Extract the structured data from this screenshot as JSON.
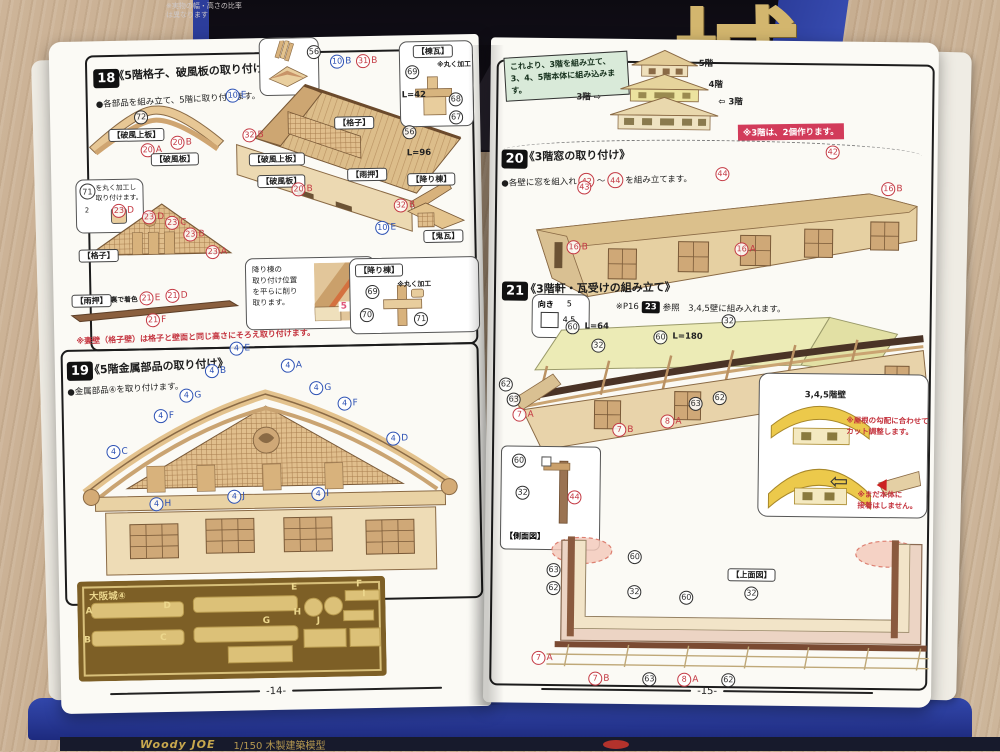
{
  "box": {
    "note": "※実物の幅・高さの比率\nは異なります",
    "kanji": "城",
    "brand": "Woody JOE",
    "brand_sub": "1/150 木製建築模型"
  },
  "left_page": {
    "footer": "-14-",
    "red_note": "※妻壁（格子壁）は格子と壁面と同じ高さにそろえ取り付けます。",
    "step18": {
      "num": "18",
      "title": "《5階格子、破風板の取り付け》",
      "bullet": "●各部品を組み立て、5階に取り付けます。",
      "note71": {
        "circ": "71",
        "text": "を丸く加工し\n取り付けます。",
        "sub": "2"
      },
      "oroshi_note": {
        "text": "降り棟の\n取り付け位置\nを平らに削り\n取ります。",
        "measure": "5 mm"
      },
      "labels": [
        {
          "k": "c",
          "n": "56",
          "x": 258,
          "y": 8
        },
        {
          "k": "c",
          "c": "c-blue",
          "n": "10",
          "s": "B",
          "x": 281,
          "y": 18
        },
        {
          "k": "c",
          "c": "c-red",
          "n": "31",
          "s": "B",
          "x": 307,
          "y": 18
        },
        {
          "k": "tag",
          "t": "【棟瓦】",
          "x": 364,
          "y": 10
        },
        {
          "k": "c",
          "n": "69",
          "x": 356,
          "y": 30
        },
        {
          "k": "txt",
          "t": "※丸く加工",
          "x": 388,
          "y": 27,
          "cls": "small"
        },
        {
          "k": "txt",
          "t": "L=42",
          "x": 352,
          "y": 56
        },
        {
          "k": "c",
          "n": "68",
          "x": 399,
          "y": 58
        },
        {
          "k": "c",
          "n": "67",
          "x": 399,
          "y": 76
        },
        {
          "k": "c",
          "c": "c-blue",
          "n": "10",
          "s": "E",
          "x": 176,
          "y": 50
        },
        {
          "k": "c",
          "n": "72",
          "x": 84,
          "y": 70
        },
        {
          "k": "tag",
          "t": "【破風上板】",
          "x": 58,
          "y": 88
        },
        {
          "k": "c",
          "c": "c-red",
          "n": "20",
          "s": "A",
          "x": 90,
          "y": 103
        },
        {
          "k": "c",
          "c": "c-red",
          "n": "20",
          "s": "B",
          "x": 120,
          "y": 96
        },
        {
          "k": "tag",
          "t": "【破風板】",
          "x": 100,
          "y": 113
        },
        {
          "k": "c",
          "c": "c-red",
          "n": "32",
          "s": "B",
          "x": 192,
          "y": 90
        },
        {
          "k": "tag",
          "t": "【破風上板】",
          "x": 198,
          "y": 115
        },
        {
          "k": "tag",
          "t": "【格子】",
          "x": 284,
          "y": 80
        },
        {
          "k": "c",
          "n": "56",
          "x": 352,
          "y": 90
        },
        {
          "k": "txt",
          "t": "L=96",
          "x": 356,
          "y": 114
        },
        {
          "k": "tag",
          "t": "【破風板】",
          "x": 206,
          "y": 137
        },
        {
          "k": "c",
          "c": "c-red",
          "n": "20",
          "s": "B",
          "x": 240,
          "y": 145
        },
        {
          "k": "tag",
          "t": "【雨押】",
          "x": 296,
          "y": 132
        },
        {
          "k": "tag",
          "t": "【降り棟】",
          "x": 356,
          "y": 138
        },
        {
          "k": "c",
          "c": "c-red",
          "n": "32",
          "s": "B",
          "x": 342,
          "y": 163
        },
        {
          "k": "c",
          "c": "c-blue",
          "n": "10",
          "s": "E",
          "x": 323,
          "y": 185
        },
        {
          "k": "tag",
          "t": "【鬼瓦】",
          "x": 371,
          "y": 195
        },
        {
          "k": "c",
          "c": "c-red",
          "n": "23",
          "s": "D",
          "x": 60,
          "y": 163
        },
        {
          "k": "c",
          "c": "c-red",
          "n": "23",
          "s": "D",
          "x": 90,
          "y": 170
        },
        {
          "k": "c",
          "c": "c-red",
          "n": "23",
          "s": "C",
          "x": 113,
          "y": 176
        },
        {
          "k": "c",
          "c": "c-red",
          "n": "23",
          "s": "B",
          "x": 131,
          "y": 188
        },
        {
          "k": "c",
          "c": "c-red",
          "n": "23",
          "s": "A",
          "x": 153,
          "y": 206
        },
        {
          "k": "tag",
          "t": "【格子】",
          "x": 26,
          "y": 208
        },
        {
          "k": "tag",
          "t": "【雨押】",
          "x": 18,
          "y": 253
        },
        {
          "k": "txt",
          "t": "裏で着色",
          "x": 57,
          "y": 256,
          "cls": "small"
        },
        {
          "k": "c",
          "c": "c-red",
          "n": "21",
          "s": "E",
          "x": 86,
          "y": 251
        },
        {
          "k": "c",
          "c": "c-red",
          "n": "21",
          "s": "D",
          "x": 112,
          "y": 249
        },
        {
          "k": "c",
          "c": "c-red",
          "n": "21",
          "s": "F",
          "x": 92,
          "y": 273
        },
        {
          "k": "tag",
          "t": "【降り棟】",
          "x": 302,
          "y": 228
        },
        {
          "k": "c",
          "n": "69",
          "x": 312,
          "y": 249
        },
        {
          "k": "txt",
          "t": "※丸く加工",
          "x": 344,
          "y": 246,
          "cls": "small"
        },
        {
          "k": "c",
          "n": "70",
          "x": 306,
          "y": 272
        },
        {
          "k": "c",
          "n": "71",
          "x": 360,
          "y": 277
        }
      ]
    },
    "step19": {
      "num": "19",
      "title": "《5階金属部品の取り付け》",
      "bullet": "●金属部品④を取り付けます。",
      "labels": [
        {
          "k": "c",
          "c": "c-blue",
          "n": "4",
          "s": "E",
          "x": 175,
          "y": 303
        },
        {
          "k": "c",
          "c": "c-blue",
          "n": "4",
          "s": "B",
          "x": 150,
          "y": 325
        },
        {
          "k": "c",
          "c": "c-blue",
          "n": "4",
          "s": "A",
          "x": 226,
          "y": 321
        },
        {
          "k": "c",
          "c": "c-blue",
          "n": "4",
          "s": "G",
          "x": 124,
          "y": 349
        },
        {
          "k": "c",
          "c": "c-blue",
          "n": "4",
          "s": "G",
          "x": 254,
          "y": 344
        },
        {
          "k": "c",
          "c": "c-blue",
          "n": "4",
          "s": "F",
          "x": 98,
          "y": 369
        },
        {
          "k": "c",
          "c": "c-blue",
          "n": "4",
          "s": "F",
          "x": 282,
          "y": 360
        },
        {
          "k": "c",
          "c": "c-blue",
          "n": "4",
          "s": "C",
          "x": 50,
          "y": 404
        },
        {
          "k": "c",
          "c": "c-blue",
          "n": "4",
          "s": "D",
          "x": 330,
          "y": 396
        },
        {
          "k": "c",
          "c": "c-blue",
          "n": "4",
          "s": "H",
          "x": 92,
          "y": 457
        },
        {
          "k": "c",
          "c": "c-blue",
          "n": "4",
          "s": "J",
          "x": 170,
          "y": 451
        },
        {
          "k": "c",
          "c": "c-blue",
          "n": "4",
          "s": "I",
          "x": 254,
          "y": 450
        }
      ]
    },
    "parts_sheet": {
      "title": "大阪城④",
      "labels": [
        {
          "k": "txt",
          "t": "A",
          "x": 26,
          "y": 566,
          "cls": "gold"
        },
        {
          "k": "txt",
          "t": "D",
          "x": 104,
          "y": 562,
          "cls": "gold"
        },
        {
          "k": "txt",
          "t": "E",
          "x": 232,
          "y": 546,
          "cls": "gold"
        },
        {
          "k": "txt",
          "t": "F",
          "x": 297,
          "y": 544,
          "cls": "gold"
        },
        {
          "k": "txt",
          "t": "H",
          "x": 234,
          "y": 571,
          "cls": "gold"
        },
        {
          "k": "txt",
          "t": "I",
          "x": 303,
          "y": 554,
          "cls": "gold"
        },
        {
          "k": "txt",
          "t": "B",
          "x": 24,
          "y": 595,
          "cls": "gold"
        },
        {
          "k": "txt",
          "t": "C",
          "x": 100,
          "y": 594,
          "cls": "gold"
        },
        {
          "k": "txt",
          "t": "G",
          "x": 203,
          "y": 579,
          "cls": "gold"
        },
        {
          "k": "txt",
          "t": "J",
          "x": 257,
          "y": 580,
          "cls": "gold"
        }
      ]
    }
  },
  "right_page": {
    "footer": "-15-",
    "intro": {
      "box": "これより、3階を組み立て、3、4、5階本体に組み込みます。",
      "badge": "※3階は、2個作ります。",
      "labels": [
        {
          "k": "txt",
          "t": "5階",
          "x": 208,
          "y": 20
        },
        {
          "k": "txt",
          "t": "4階",
          "x": 218,
          "y": 41
        },
        {
          "k": "txt",
          "t": "3階 ⇨",
          "x": 86,
          "y": 55
        },
        {
          "k": "txt",
          "t": "⇦ 3階",
          "x": 228,
          "y": 58
        }
      ]
    },
    "step20": {
      "num": "20",
      "title": "《3階窓の取り付け》",
      "bullet_pre": "●各壁に窓を組入れ",
      "n1": "42",
      "tilde": "～",
      "n2": "44",
      "bullet_post": "を組み立てます。",
      "labels": [
        {
          "k": "c",
          "c": "c-red",
          "n": "43",
          "x": 88,
          "y": 142
        },
        {
          "k": "c",
          "c": "c-red",
          "n": "44",
          "x": 226,
          "y": 127
        },
        {
          "k": "c",
          "c": "c-red",
          "n": "42",
          "x": 336,
          "y": 104
        },
        {
          "k": "c",
          "c": "c-red",
          "n": "16",
          "s": "B",
          "x": 392,
          "y": 140
        },
        {
          "k": "c",
          "c": "c-red",
          "n": "16",
          "s": "B",
          "x": 78,
          "y": 202
        },
        {
          "k": "c",
          "c": "c-red",
          "n": "16",
          "s": "A",
          "x": 246,
          "y": 202
        }
      ]
    },
    "step21": {
      "num": "21",
      "title": "《3階軒・瓦受けの組み立て》",
      "ref_pre": "※P16",
      "ref_sq": "23",
      "ref_post": "参照　3,4,5壁に組み入れます。",
      "muki": {
        "t1": "向き",
        "t2": "5",
        "t3": "4.5"
      },
      "yellow_tag": "3,4,5階壁",
      "yellow_note1": "※屋根の勾配に合わせて\nカット調整します。",
      "yellow_note2": "※まだ本体に\n接着はしません。",
      "arrow": "⇦",
      "side_caption": "【側面図】",
      "labels": [
        {
          "k": "c",
          "n": "60",
          "x": 78,
          "y": 282
        },
        {
          "k": "txt",
          "t": "L=64",
          "x": 97,
          "y": 284
        },
        {
          "k": "c",
          "n": "32",
          "x": 104,
          "y": 300
        },
        {
          "k": "c",
          "n": "60",
          "x": 166,
          "y": 291
        },
        {
          "k": "txt",
          "t": "L=180",
          "x": 185,
          "y": 293
        },
        {
          "k": "c",
          "n": "32",
          "x": 234,
          "y": 274
        },
        {
          "k": "c",
          "n": "62",
          "x": 12,
          "y": 340
        },
        {
          "k": "c",
          "n": "63",
          "x": 20,
          "y": 355
        },
        {
          "k": "c",
          "c": "c-red",
          "n": "7",
          "s": "A",
          "x": 26,
          "y": 370
        },
        {
          "k": "c",
          "c": "c-red",
          "n": "7",
          "s": "B",
          "x": 126,
          "y": 384
        },
        {
          "k": "c",
          "c": "c-red",
          "n": "8",
          "s": "A",
          "x": 174,
          "y": 375
        },
        {
          "k": "c",
          "n": "63",
          "x": 202,
          "y": 357
        },
        {
          "k": "c",
          "n": "62",
          "x": 226,
          "y": 351
        },
        {
          "k": "c",
          "n": "60",
          "x": 26,
          "y": 416
        },
        {
          "k": "c",
          "n": "32",
          "x": 30,
          "y": 448
        },
        {
          "k": "c",
          "c": "c-red",
          "n": "44",
          "x": 82,
          "y": 452
        },
        {
          "k": "txt",
          "t": "3,4,5階壁",
          "x": 318,
          "y": 350
        }
      ]
    },
    "top_view": {
      "caption": "【上面図】",
      "labels": [
        {
          "k": "tag",
          "t": "【上面図】",
          "x": 243,
          "y": 528
        },
        {
          "k": "c",
          "n": "60",
          "x": 143,
          "y": 511
        },
        {
          "k": "c",
          "n": "63",
          "x": 62,
          "y": 525
        },
        {
          "k": "c",
          "n": "62",
          "x": 62,
          "y": 543
        },
        {
          "k": "c",
          "n": "32",
          "x": 143,
          "y": 546
        },
        {
          "k": "c",
          "n": "60",
          "x": 195,
          "y": 551
        },
        {
          "k": "c",
          "n": "32",
          "x": 260,
          "y": 546
        },
        {
          "k": "c",
          "c": "c-red",
          "n": "7",
          "s": "A",
          "x": 48,
          "y": 613
        },
        {
          "k": "c",
          "c": "c-red",
          "n": "7",
          "s": "B",
          "x": 105,
          "y": 633
        },
        {
          "k": "c",
          "n": "63",
          "x": 159,
          "y": 633
        },
        {
          "k": "c",
          "c": "c-red",
          "n": "8",
          "s": "A",
          "x": 194,
          "y": 633
        },
        {
          "k": "c",
          "n": "62",
          "x": 238,
          "y": 633
        }
      ]
    }
  }
}
